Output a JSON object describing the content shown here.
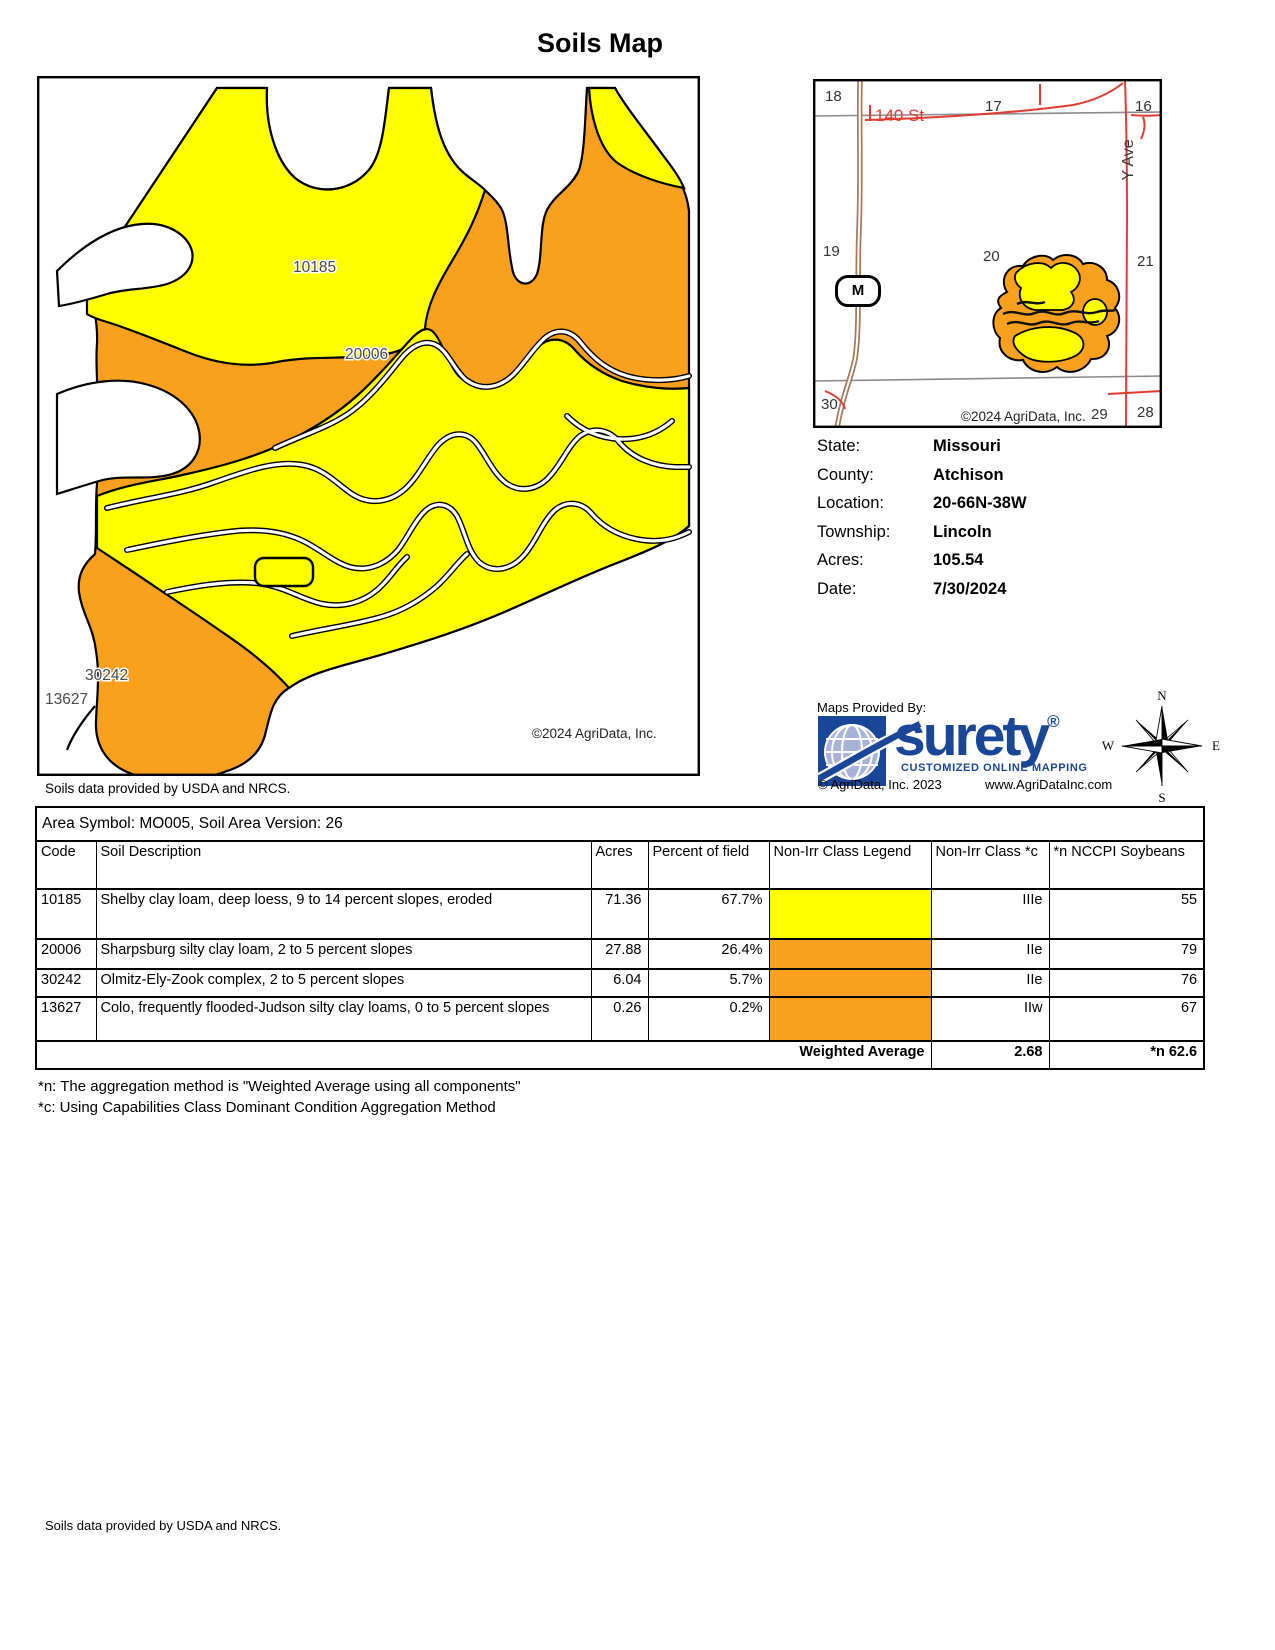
{
  "title": "Soils Map",
  "map": {
    "labels": [
      "10185",
      "20006",
      "30242",
      "13627"
    ],
    "copyright": "©2024 AgriData, Inc.",
    "source_note": "Soils data provided by USDA and NRCS."
  },
  "inset": {
    "sections": [
      "18",
      "17",
      "16",
      "19",
      "20",
      "21",
      "30",
      "29",
      "28"
    ],
    "road_140": "140 St",
    "road_y": "Y Ave",
    "highway_marker": "M",
    "copyright": "©2024 AgriData, Inc."
  },
  "info": {
    "rows": [
      {
        "label": "State:",
        "value": "Missouri"
      },
      {
        "label": "County:",
        "value": "Atchison"
      },
      {
        "label": "Location:",
        "value": "20-66N-38W"
      },
      {
        "label": "Township:",
        "value": "Lincoln"
      },
      {
        "label": "Acres:",
        "value": "105.54"
      },
      {
        "label": "Date:",
        "value": "7/30/2024"
      }
    ]
  },
  "branding": {
    "maps_provided_by": "Maps Provided By:",
    "logo_text": "surety",
    "registered": "®",
    "tagline": "CUSTOMIZED ONLINE MAPPING",
    "copyright": "© AgriData, Inc. 2023",
    "website": "www.AgriDataInc.com"
  },
  "compass": {
    "n": "N",
    "e": "E",
    "s": "S",
    "w": "W"
  },
  "table": {
    "area_title": "Area Symbol: MO005, Soil Area Version: 26",
    "headers": [
      "Code",
      "Soil Description",
      "Acres",
      "Percent of field",
      "Non-Irr Class Legend",
      "Non-Irr Class *c",
      "*n NCCPI Soybeans"
    ],
    "rows": [
      {
        "code": "10185",
        "description": "Shelby clay loam, deep loess, 9 to 14 percent slopes, eroded",
        "acres": "71.36",
        "percent": "67.7%",
        "legend_color": "#FFFF00",
        "class": "IIIe",
        "nccpi": "55"
      },
      {
        "code": "20006",
        "description": "Sharpsburg silty clay loam, 2 to 5 percent slopes",
        "acres": "27.88",
        "percent": "26.4%",
        "legend_color": "#F9A11E",
        "class": "IIe",
        "nccpi": "79"
      },
      {
        "code": "30242",
        "description": "Olmitz-Ely-Zook complex, 2 to 5 percent slopes",
        "acres": "6.04",
        "percent": "5.7%",
        "legend_color": "#F9A11E",
        "class": "IIe",
        "nccpi": "76"
      },
      {
        "code": "13627",
        "description": "Colo, frequently flooded-Judson silty clay loams, 0 to 5 percent slopes",
        "acres": "0.26",
        "percent": "0.2%",
        "legend_color": "#F9A11E",
        "class": "IIw",
        "nccpi": "67"
      }
    ],
    "weighted_average": {
      "label": "Weighted Average",
      "class": "2.68",
      "nccpi": "*n 62.6"
    }
  },
  "footnotes": [
    "*n: The aggregation method is \"Weighted Average using all components\"",
    "*c: Using Capabilities Class Dominant Condition Aggregation Method"
  ],
  "footer": "Soils data provided by USDA and NRCS.",
  "colors": {
    "yellow": "#FFFF00",
    "orange": "#F9A11E",
    "road_red": "#E03C31",
    "brand_blue": "#1A4697"
  }
}
